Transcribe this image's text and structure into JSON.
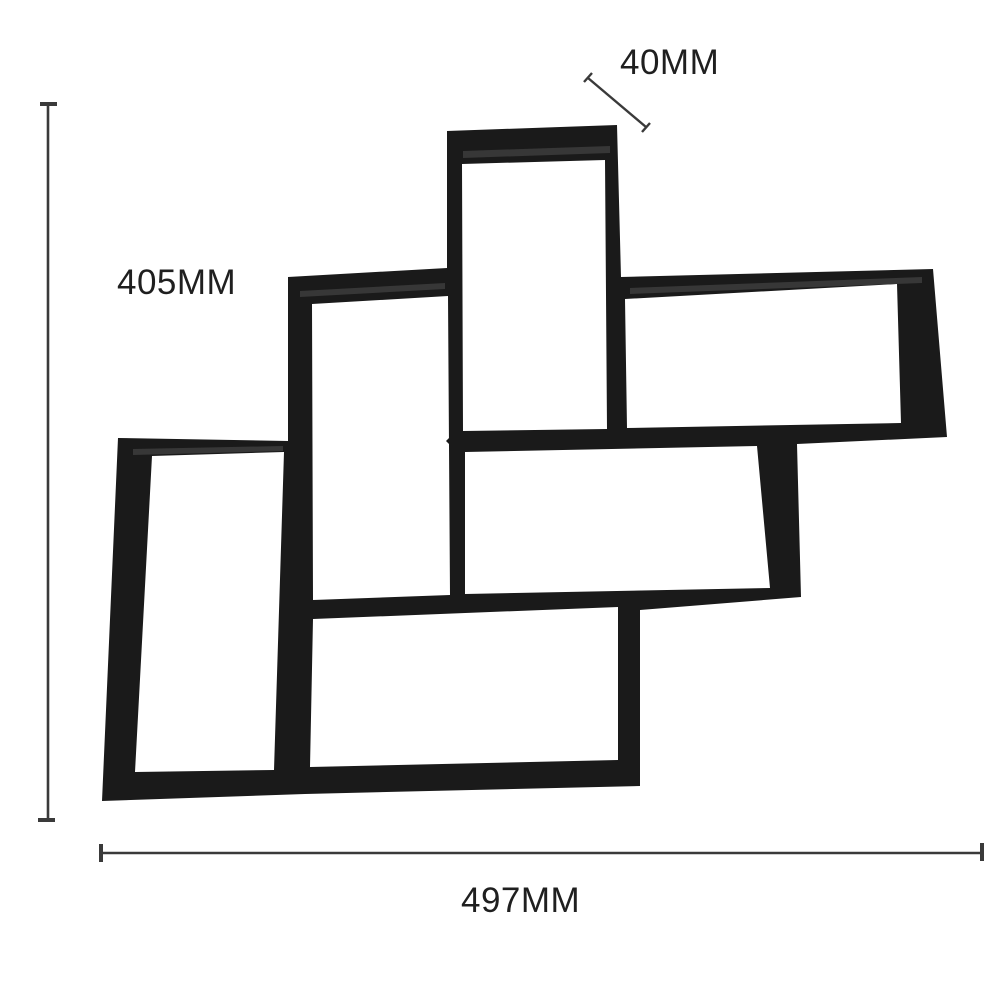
{
  "annotations": {
    "thickness": "40MM",
    "height": "405MM",
    "width": "497MM"
  },
  "colors": {
    "background": "#ffffff",
    "mold": "#1a1a1a",
    "mold_highlight": "#373737",
    "dimension_line": "#3a3a3a",
    "label_text": "#1f1f1f"
  }
}
